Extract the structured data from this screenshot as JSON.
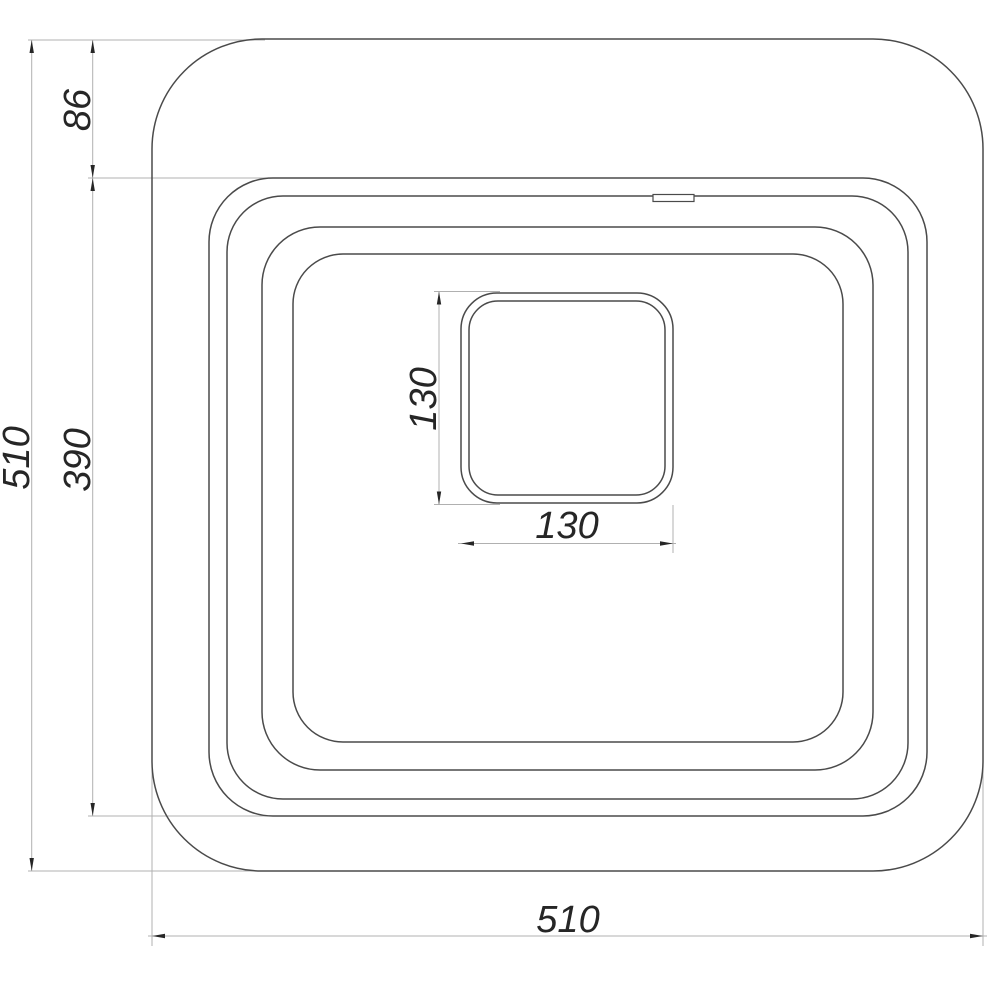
{
  "drawing": {
    "labels": {
      "overall_height": "510",
      "deck_depth": "86",
      "bowl_depth": "390",
      "overall_width": "510",
      "drain_height": "130",
      "drain_width": "130"
    },
    "colors": {
      "background": "#ffffff",
      "outline": "#4a4a4a",
      "dimension_line": "#b0b0b0",
      "text_and_arrows": "#262626"
    }
  }
}
